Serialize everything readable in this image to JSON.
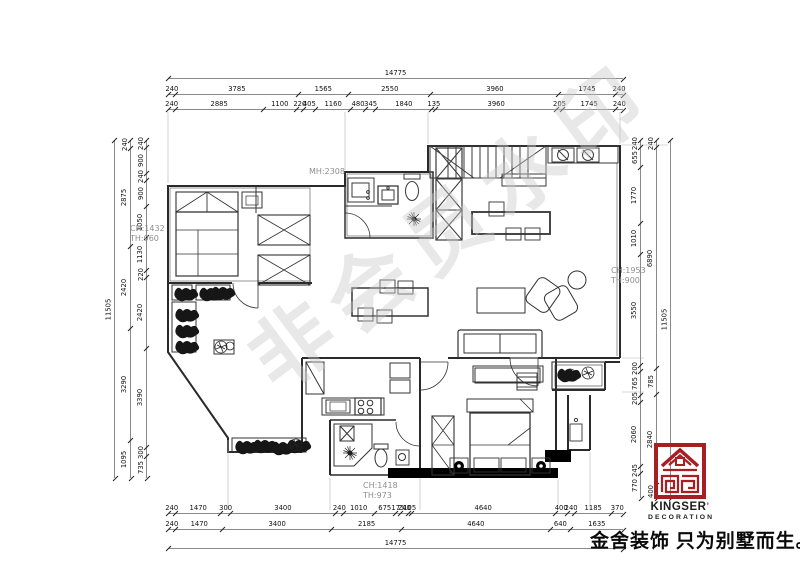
{
  "watermark": "非会员水印",
  "slogan": "金舍装饰 只为别墅而生。",
  "logo": {
    "name": "KINGSER",
    "mark": "’",
    "subtitle": "DECORATION",
    "color": "#a91e23"
  },
  "annotations": {
    "mh": "MH:2308",
    "left_ch": "CH:1432",
    "left_th": "TH:960",
    "right_ch": "CH:1953",
    "right_th": "TH:900",
    "bottom_ch": "CH:1418",
    "bottom_th": "TH:973"
  },
  "dimensions": {
    "top": {
      "total": [
        14775
      ],
      "row2": [
        240,
        3785,
        1565,
        2550,
        3960,
        1745,
        240
      ],
      "row3": [
        240,
        2885,
        1100,
        220,
        405,
        1160,
        480,
        345,
        1840,
        135,
        3960,
        205,
        1745,
        240
      ]
    },
    "bottom": {
      "row1": [
        240,
        1470,
        300,
        3400,
        240,
        1010,
        675,
        175,
        240,
        105,
        4640,
        400,
        240,
        1185,
        370
      ],
      "row2": [
        240,
        1470,
        3400,
        2185,
        4640,
        640,
        1635
      ],
      "total": [
        14775
      ]
    },
    "left": {
      "outer": [
        11505
      ],
      "mid": [
        240,
        2875,
        2420,
        3290,
        1095
      ],
      "inner": [
        240,
        900,
        240,
        900,
        1050,
        1130,
        220,
        2420,
        3390,
        300,
        735
      ]
    },
    "right": {
      "inner": [
        240,
        655,
        1770,
        1010,
        3550,
        200,
        765,
        205,
        2060,
        245,
        770
      ],
      "mid": [
        240,
        6890,
        785,
        2840,
        400
      ],
      "outer": [
        11505
      ]
    }
  }
}
